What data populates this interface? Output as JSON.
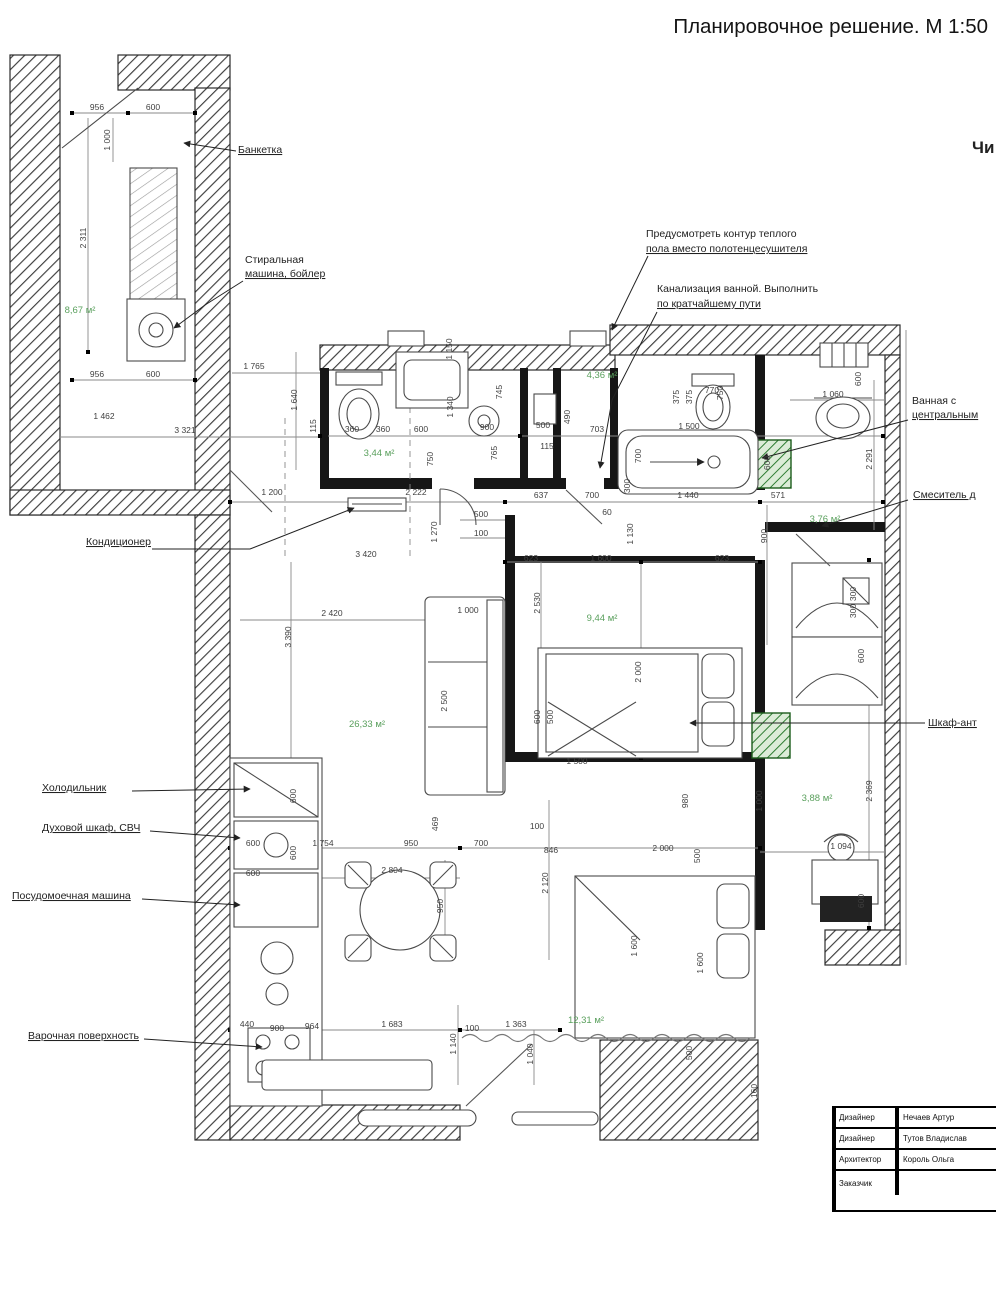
{
  "title": "Планировочное решение. М 1:50",
  "edge_text": "Чи",
  "callouts": {
    "bench": {
      "text": "Банкетка"
    },
    "washer": {
      "line1": "Стиральная",
      "line2": "машина, бойлер"
    },
    "ac": {
      "text": "Кондиционер"
    },
    "fridge": {
      "text": "Холодильник"
    },
    "oven": {
      "text": "Духовой шкаф, СВЧ"
    },
    "dishwasher": {
      "text": "Посудомоечная машина"
    },
    "hob": {
      "text": "Варочная поверхность"
    },
    "bath_central": {
      "line1": "Ванная с",
      "line2": "центральным"
    },
    "mixer": {
      "text": "Смеситель д"
    },
    "wardrobe": {
      "text": "Шкаф-ант"
    }
  },
  "notes": {
    "heated_floor": {
      "line1": "Предусмотреть контур теплого",
      "line2": "пола вместо полотенцесушителя"
    },
    "drain": {
      "line1": "Канализация ванной. Выполнить",
      "line2": "по кратчайшему пути"
    }
  },
  "room_areas": [
    {
      "t": "8,67 м²",
      "x": 80,
      "y": 313
    },
    {
      "t": "3,44 м²",
      "x": 379,
      "y": 456
    },
    {
      "t": "4,36 м²",
      "x": 602,
      "y": 378
    },
    {
      "t": "3,76 м²",
      "x": 825,
      "y": 522
    },
    {
      "t": "9,44 м²",
      "x": 602,
      "y": 621
    },
    {
      "t": "26,33 м²",
      "x": 367,
      "y": 727
    },
    {
      "t": "3,88 м²",
      "x": 817,
      "y": 801
    },
    {
      "t": "12,31 м²",
      "x": 586,
      "y": 1023
    }
  ],
  "dimensions": [
    {
      "t": "956",
      "x": 97,
      "y": 110
    },
    {
      "t": "600",
      "x": 153,
      "y": 110
    },
    {
      "t": "1 000",
      "x": 110,
      "y": 140,
      "r": -90
    },
    {
      "t": "2 311",
      "x": 86,
      "y": 238,
      "r": -90
    },
    {
      "t": "956",
      "x": 97,
      "y": 377
    },
    {
      "t": "600",
      "x": 153,
      "y": 377
    },
    {
      "t": "1 462",
      "x": 104,
      "y": 419
    },
    {
      "t": "3 321",
      "x": 185,
      "y": 433
    },
    {
      "t": "1 765",
      "x": 254,
      "y": 369
    },
    {
      "t": "1 640",
      "x": 297,
      "y": 400,
      "r": -90
    },
    {
      "t": "115",
      "x": 316,
      "y": 426,
      "r": -90
    },
    {
      "t": "1 150",
      "x": 452,
      "y": 349,
      "r": -90
    },
    {
      "t": "360",
      "x": 352,
      "y": 432
    },
    {
      "t": "360",
      "x": 383,
      "y": 432
    },
    {
      "t": "600",
      "x": 421,
      "y": 432
    },
    {
      "t": "900",
      "x": 487,
      "y": 430
    },
    {
      "t": "1 340",
      "x": 453,
      "y": 407,
      "r": -90
    },
    {
      "t": "745",
      "x": 502,
      "y": 392,
      "r": -90
    },
    {
      "t": "750",
      "x": 433,
      "y": 459,
      "r": -90
    },
    {
      "t": "765",
      "x": 497,
      "y": 453,
      "r": -90
    },
    {
      "t": "500",
      "x": 543,
      "y": 428
    },
    {
      "t": "115",
      "x": 547,
      "y": 449
    },
    {
      "t": "490",
      "x": 570,
      "y": 417,
      "r": -90
    },
    {
      "t": "703",
      "x": 597,
      "y": 432
    },
    {
      "t": "770",
      "x": 712,
      "y": 393
    },
    {
      "t": "375",
      "x": 679,
      "y": 397,
      "r": -90
    },
    {
      "t": "375",
      "x": 692,
      "y": 397,
      "r": -90
    },
    {
      "t": "750",
      "x": 723,
      "y": 393,
      "r": -90
    },
    {
      "t": "1 500",
      "x": 689,
      "y": 429
    },
    {
      "t": "700",
      "x": 641,
      "y": 456,
      "r": -90
    },
    {
      "t": "300",
      "x": 630,
      "y": 486,
      "r": -90
    },
    {
      "t": "600",
      "x": 770,
      "y": 463,
      "r": -90
    },
    {
      "t": "1 060",
      "x": 833,
      "y": 397
    },
    {
      "t": "600",
      "x": 861,
      "y": 379,
      "r": -90
    },
    {
      "t": "2 291",
      "x": 872,
      "y": 459,
      "r": -90
    },
    {
      "t": "1 200",
      "x": 272,
      "y": 495
    },
    {
      "t": "2 222",
      "x": 416,
      "y": 495
    },
    {
      "t": "500",
      "x": 481,
      "y": 517
    },
    {
      "t": "100",
      "x": 481,
      "y": 536
    },
    {
      "t": "637",
      "x": 541,
      "y": 498
    },
    {
      "t": "700",
      "x": 592,
      "y": 498
    },
    {
      "t": "60",
      "x": 607,
      "y": 515
    },
    {
      "t": "1 440",
      "x": 688,
      "y": 498
    },
    {
      "t": "571",
      "x": 778,
      "y": 498
    },
    {
      "t": "1 130",
      "x": 633,
      "y": 534,
      "r": -90
    },
    {
      "t": "900",
      "x": 767,
      "y": 536,
      "r": -90
    },
    {
      "t": "1 270",
      "x": 437,
      "y": 532,
      "r": -90
    },
    {
      "t": "3 420",
      "x": 366,
      "y": 557
    },
    {
      "t": "623",
      "x": 531,
      "y": 561
    },
    {
      "t": "1 600",
      "x": 601,
      "y": 561
    },
    {
      "t": "623",
      "x": 722,
      "y": 561
    },
    {
      "t": "2 420",
      "x": 332,
      "y": 616
    },
    {
      "t": "3 390",
      "x": 291,
      "y": 637,
      "r": -90
    },
    {
      "t": "1 000",
      "x": 468,
      "y": 613
    },
    {
      "t": "2 530",
      "x": 540,
      "y": 603,
      "r": -90
    },
    {
      "t": "2 500",
      "x": 447,
      "y": 701,
      "r": -90
    },
    {
      "t": "2 000",
      "x": 641,
      "y": 672,
      "r": -90
    },
    {
      "t": "1 500",
      "x": 577,
      "y": 764
    },
    {
      "t": "300",
      "x": 856,
      "y": 594,
      "r": -90
    },
    {
      "t": "300",
      "x": 856,
      "y": 611,
      "r": -90
    },
    {
      "t": "600",
      "x": 864,
      "y": 656,
      "r": -90
    },
    {
      "t": "600",
      "x": 540,
      "y": 717,
      "r": -90
    },
    {
      "t": "500",
      "x": 553,
      "y": 717,
      "r": -90
    },
    {
      "t": "980",
      "x": 688,
      "y": 801,
      "r": -90
    },
    {
      "t": "1 000",
      "x": 762,
      "y": 801,
      "r": -90
    },
    {
      "t": "2 369",
      "x": 872,
      "y": 791,
      "r": -90
    },
    {
      "t": "600",
      "x": 296,
      "y": 796,
      "r": -90
    },
    {
      "t": "600",
      "x": 296,
      "y": 853,
      "r": -90
    },
    {
      "t": "600",
      "x": 253,
      "y": 846
    },
    {
      "t": "600",
      "x": 253,
      "y": 876
    },
    {
      "t": "1 754",
      "x": 323,
      "y": 846
    },
    {
      "t": "950",
      "x": 411,
      "y": 846
    },
    {
      "t": "700",
      "x": 481,
      "y": 846
    },
    {
      "t": "846",
      "x": 551,
      "y": 853
    },
    {
      "t": "2 804",
      "x": 392,
      "y": 873
    },
    {
      "t": "469",
      "x": 438,
      "y": 824,
      "r": -90
    },
    {
      "t": "100",
      "x": 537,
      "y": 829
    },
    {
      "t": "950",
      "x": 443,
      "y": 906,
      "r": -90
    },
    {
      "t": "2 120",
      "x": 548,
      "y": 883,
      "r": -90
    },
    {
      "t": "2 000",
      "x": 663,
      "y": 851
    },
    {
      "t": "500",
      "x": 700,
      "y": 856,
      "r": -90
    },
    {
      "t": "1 094",
      "x": 841,
      "y": 849
    },
    {
      "t": "600",
      "x": 864,
      "y": 901,
      "r": -90
    },
    {
      "t": "440",
      "x": 247,
      "y": 1027
    },
    {
      "t": "900",
      "x": 277,
      "y": 1031
    },
    {
      "t": "964",
      "x": 312,
      "y": 1029
    },
    {
      "t": "1 683",
      "x": 392,
      "y": 1027
    },
    {
      "t": "100",
      "x": 472,
      "y": 1031
    },
    {
      "t": "1 363",
      "x": 516,
      "y": 1027
    },
    {
      "t": "1 140",
      "x": 456,
      "y": 1044,
      "r": -90
    },
    {
      "t": "1 040",
      "x": 533,
      "y": 1054,
      "r": -90
    },
    {
      "t": "1 600",
      "x": 637,
      "y": 946,
      "r": -90
    },
    {
      "t": "1 600",
      "x": 703,
      "y": 963,
      "r": -90
    },
    {
      "t": "500",
      "x": 692,
      "y": 1053,
      "r": -90
    },
    {
      "t": "160",
      "x": 757,
      "y": 1091,
      "r": -90
    }
  ],
  "title_block": {
    "rows": [
      {
        "role": "Дизайнер",
        "name": "Нечаев Артур"
      },
      {
        "role": "Дизайнер",
        "name": "Тутов Владислав"
      },
      {
        "role": "Архитектор",
        "name": "Король Ольга"
      },
      {
        "role": "Заказчик",
        "name": ""
      }
    ]
  }
}
